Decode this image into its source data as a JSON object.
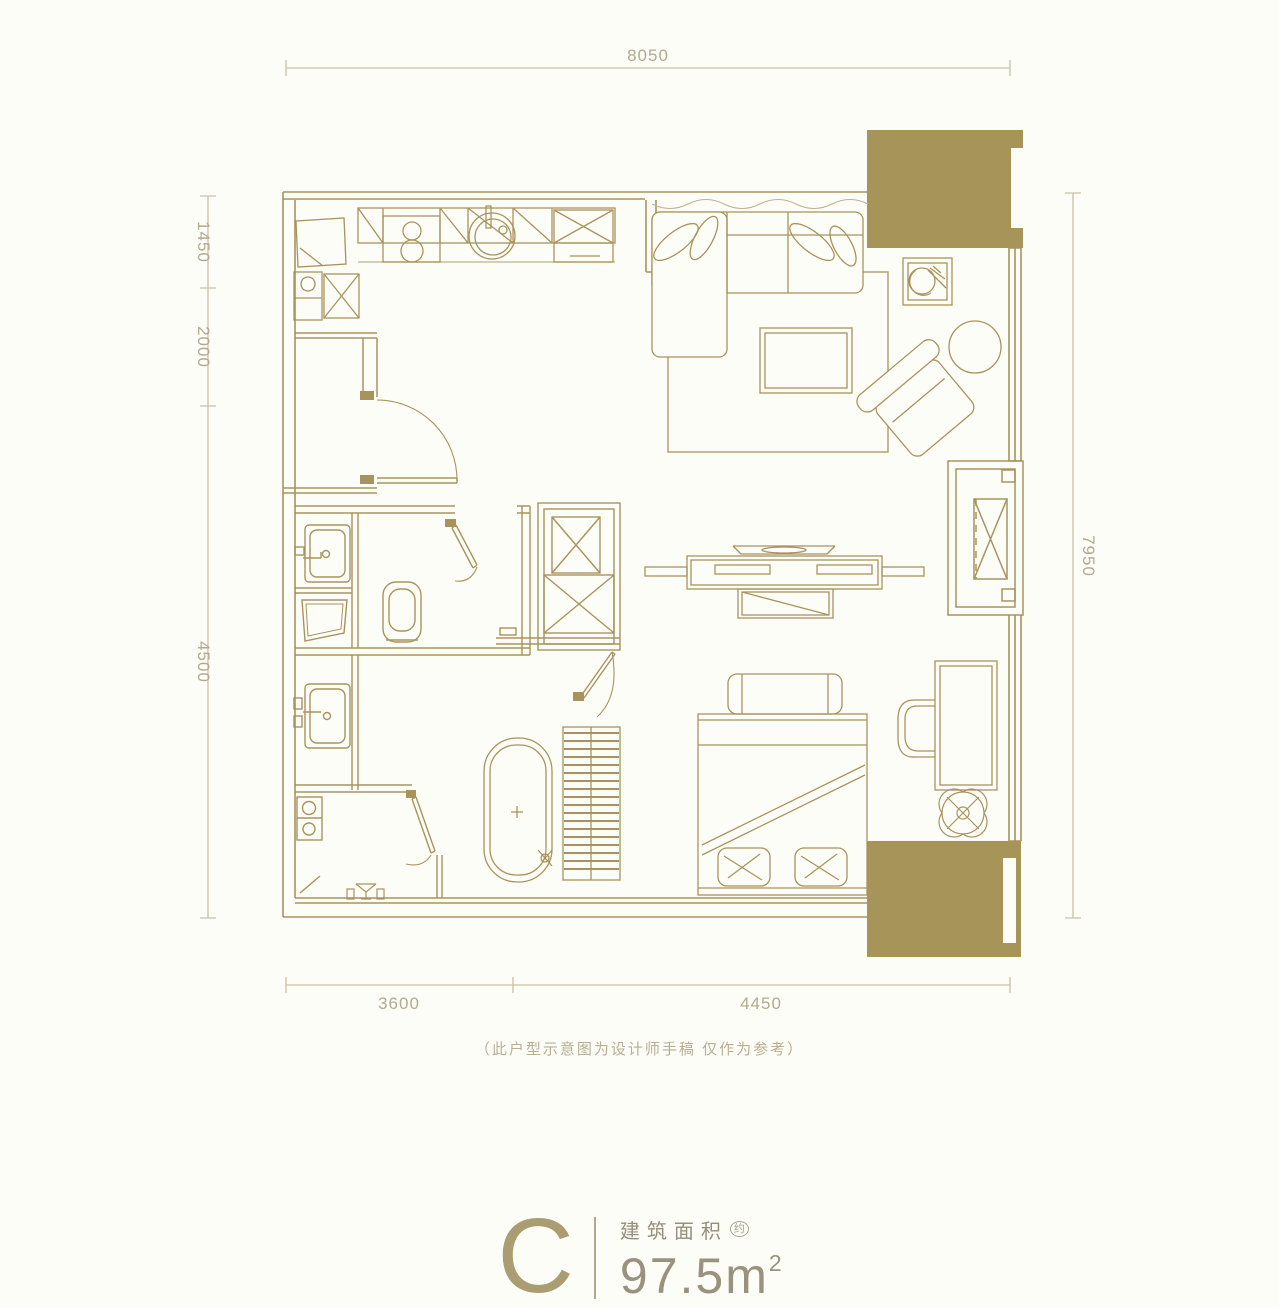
{
  "palette": {
    "line": "#a8935d",
    "gold_fill": "#a79459",
    "dim_line": "#c8c1a3",
    "dim_text": "#b2aa8e",
    "background": "#fdfdf8",
    "footer_letter": "#ab9d72",
    "footer_label": "#948e7a",
    "footer_value": "#98927e",
    "footnote": "#b7ae93"
  },
  "dimensions": {
    "top": {
      "label": "8050"
    },
    "left": [
      {
        "label": "1450"
      },
      {
        "label": "2000"
      },
      {
        "label": "4500"
      }
    ],
    "right": {
      "label": "7950"
    },
    "bottom": [
      {
        "label": "3600"
      },
      {
        "label": "4450"
      }
    ]
  },
  "footnote": "（此户型示意图为设计师手稿 仅作为参考）",
  "footer": {
    "unit_letter": "C",
    "area_label": "建筑面积",
    "area_qualifier": "约",
    "area_value": "97.5m",
    "area_superscript": "2"
  },
  "plan_elements": [
    "kitchen-counter",
    "gas-stove",
    "kitchen-sink",
    "refrigerator",
    "kitchen-cabinet",
    "entry-door",
    "bathroom",
    "washbasin",
    "toilet",
    "shower-tray",
    "second-washbasin",
    "laundry-room",
    "washing-machine",
    "floor-drain",
    "hall-closet",
    "bedroom-door",
    "sofa",
    "rug",
    "coffee-table",
    "potted-plant",
    "armchair",
    "side-table",
    "dining-table",
    "sideboard",
    "bed",
    "bed-pillows",
    "desk",
    "desk-chair",
    "ceiling-fan-symbol",
    "wardrobe",
    "bathtub",
    "bay-window",
    "balcony-block-top",
    "balcony-block-bottom"
  ]
}
